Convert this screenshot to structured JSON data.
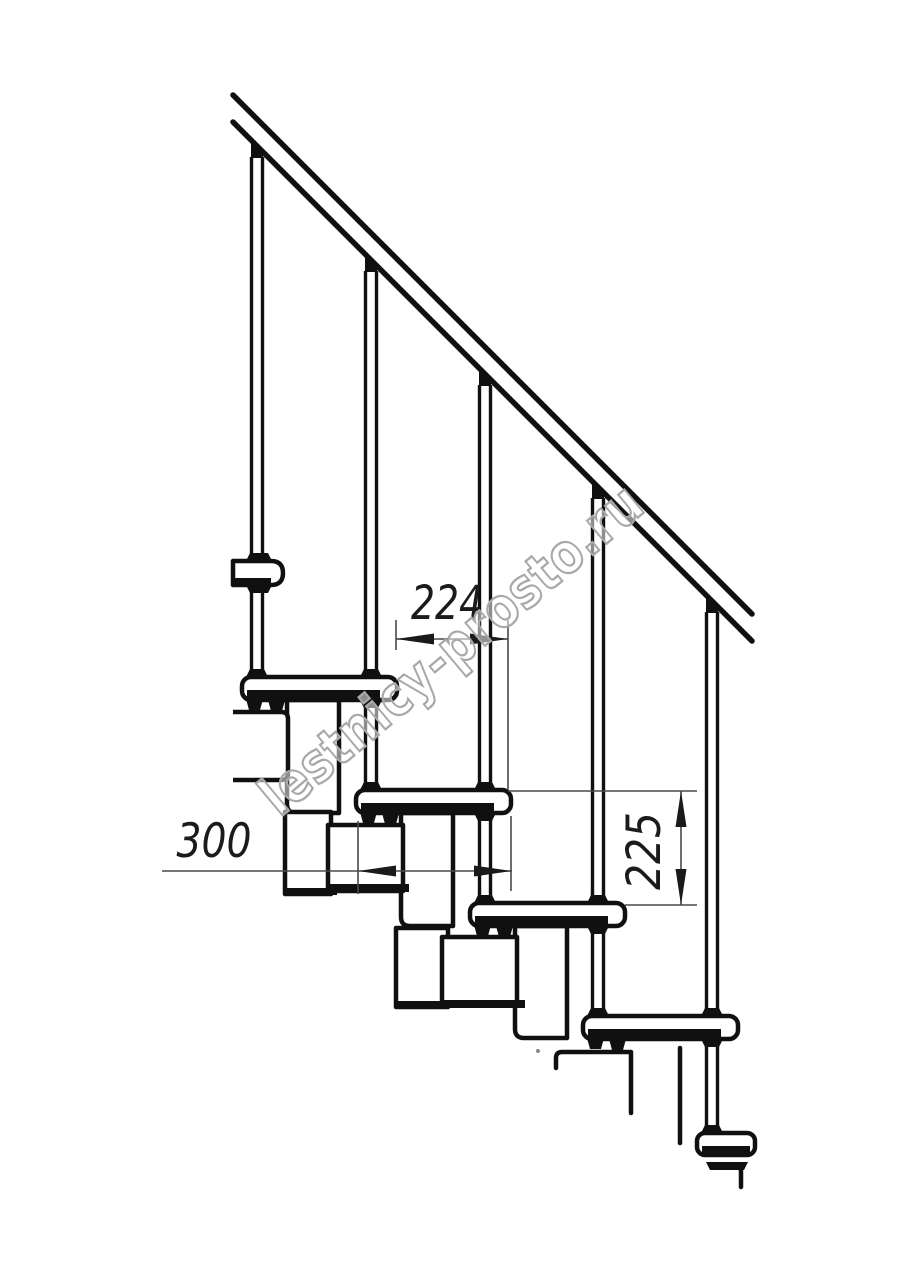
{
  "document": {
    "type": "technical-drawing",
    "subject": "Modular staircase side view with handrail, balusters, treads and support modules",
    "background": "#ffffff"
  },
  "annotations": {
    "step_spacing": {
      "label": "224",
      "orientation": "horizontal"
    },
    "tread_depth": {
      "label": "300",
      "orientation": "horizontal"
    },
    "riser_height": {
      "label": "225",
      "orientation": "vertical"
    }
  },
  "watermark": {
    "text": "lestnicy-prosto.ru"
  },
  "style": {
    "line_color": "#101010",
    "dim_line_color": "#4a4a4a",
    "dim_text_color": "#1b1b1b",
    "watermark_color": "#a8a8a8"
  }
}
